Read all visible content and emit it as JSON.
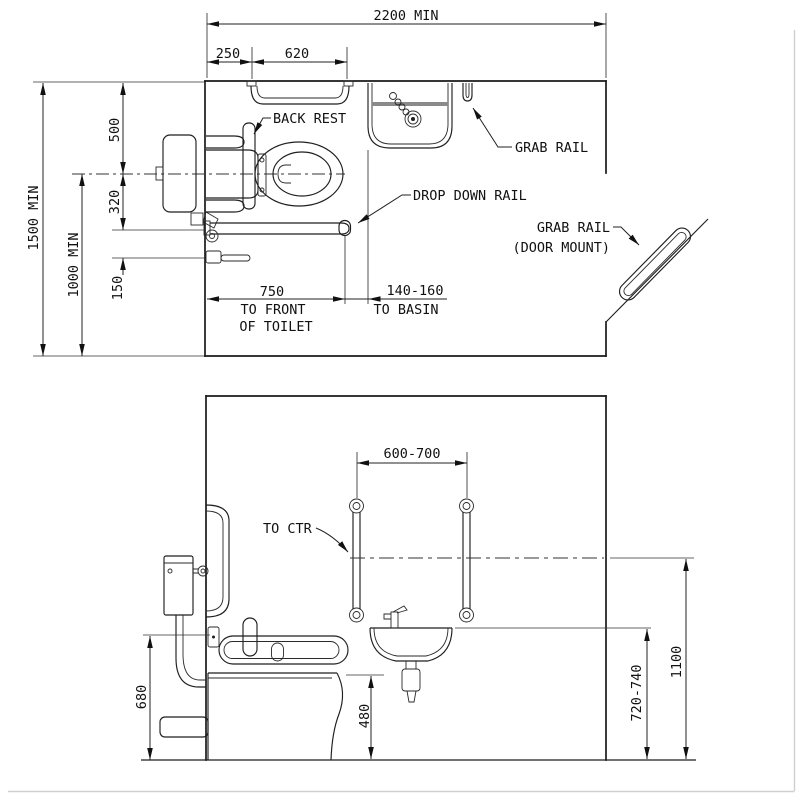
{
  "page": {
    "title": "Accessible toilet room layout drawing",
    "background_color": "#ffffff",
    "line_color": "#1a1a1a"
  },
  "plan_view": {
    "dimensions": {
      "overall_width": "2200 MIN",
      "wall_to_rail": "250",
      "rail_length": "620",
      "room_depth": "1500 MIN",
      "centerline_to_wall": "1000 MIN",
      "wall_to_centerline": "500",
      "centerline_to_rail": "320",
      "rail_to_holder": "150",
      "to_front_value": "750",
      "to_front_line1": "TO FRONT",
      "to_front_line2": "OF TOILET",
      "to_basin_value": "140-160",
      "to_basin_label": "TO BASIN"
    },
    "labels": {
      "back_rest": "BACK REST",
      "drop_down_rail": "DROP DOWN RAIL",
      "grab_rail": "GRAB RAIL",
      "grab_rail_door_line1": "GRAB RAIL",
      "grab_rail_door_line2": "(DOOR MOUNT)"
    }
  },
  "elevation_view": {
    "dimensions": {
      "rail_spacing": "600-700",
      "rail_height": "680",
      "seat_height": "480",
      "basin_rim_height": "720-740",
      "rail_center_height": "1100"
    },
    "labels": {
      "to_center": "TO CTR"
    }
  }
}
